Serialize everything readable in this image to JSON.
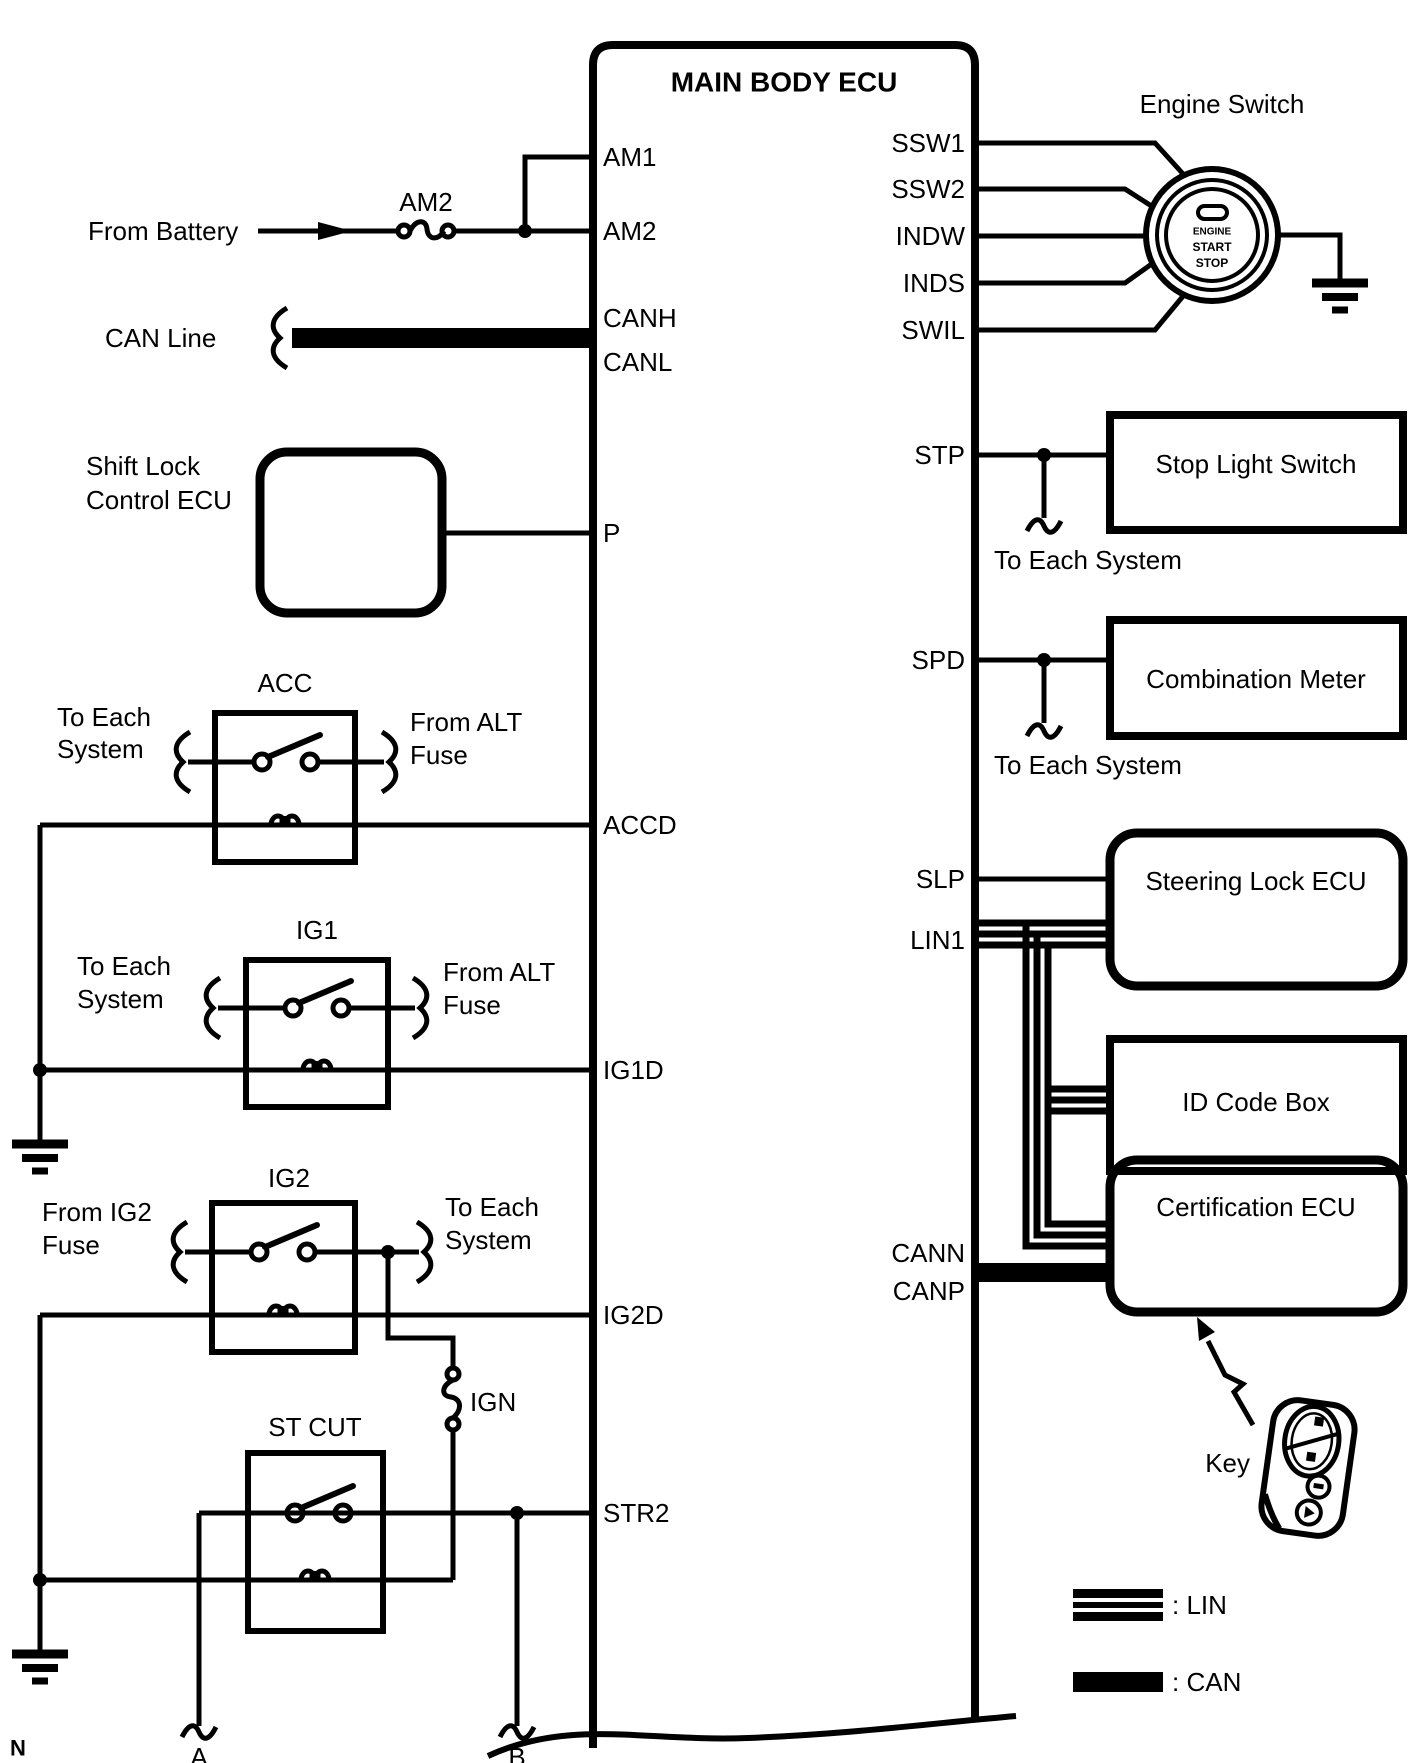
{
  "colors": {
    "ink": "#000000",
    "paper": "#ffffff"
  },
  "ecu": {
    "title": "MAIN BODY ECU",
    "left_pins": [
      {
        "label": "AM1"
      },
      {
        "label": "AM2"
      },
      {
        "label": "CANH"
      },
      {
        "label": "CANL"
      },
      {
        "label": "P"
      },
      {
        "label": "ACCD"
      },
      {
        "label": "IG1D"
      },
      {
        "label": "IG2D"
      },
      {
        "label": "STR2"
      }
    ],
    "right_pins": [
      {
        "label": "SSW1"
      },
      {
        "label": "SSW2"
      },
      {
        "label": "INDW"
      },
      {
        "label": "INDS"
      },
      {
        "label": "SWIL"
      },
      {
        "label": "STP"
      },
      {
        "label": "SPD"
      },
      {
        "label": "SLP"
      },
      {
        "label": "LIN1"
      },
      {
        "label": "CANN"
      },
      {
        "label": "CANP"
      }
    ]
  },
  "sources": {
    "from_battery": "From Battery",
    "am2_fuse": "AM2",
    "can_line": "CAN Line",
    "ign_fuse": "IGN"
  },
  "shift_lock": {
    "line1": "Shift Lock",
    "line2": "Control ECU"
  },
  "relays": {
    "acc": {
      "name": "ACC",
      "left1": "To Each",
      "left2": "System",
      "right1": "From ALT",
      "right2": "Fuse"
    },
    "ig1": {
      "name": "IG1",
      "left1": "To Each",
      "left2": "System",
      "right1": "From ALT",
      "right2": "Fuse"
    },
    "ig2": {
      "name": "IG2",
      "left1": "From IG2",
      "left2": "Fuse",
      "right1": "To Each",
      "right2": "System"
    },
    "st_cut": {
      "name": "ST CUT"
    }
  },
  "right_column": {
    "engine_switch": {
      "label": "Engine Switch",
      "button": {
        "line1": "ENGINE",
        "line2": "START",
        "line3": "STOP"
      }
    },
    "stop_light_switch": "Stop Light Switch",
    "stp_note": "To Each System",
    "combination_meter": "Combination Meter",
    "spd_note": "To Each System",
    "steering_lock_ecu": "Steering Lock ECU",
    "id_code_box": "ID Code Box",
    "certification_ecu": "Certification ECU",
    "key_label": "Key"
  },
  "connectors": {
    "a": "A",
    "b": "B"
  },
  "legend": {
    "lin": ": LIN",
    "can": ": CAN"
  },
  "footer": {
    "note": "N"
  }
}
